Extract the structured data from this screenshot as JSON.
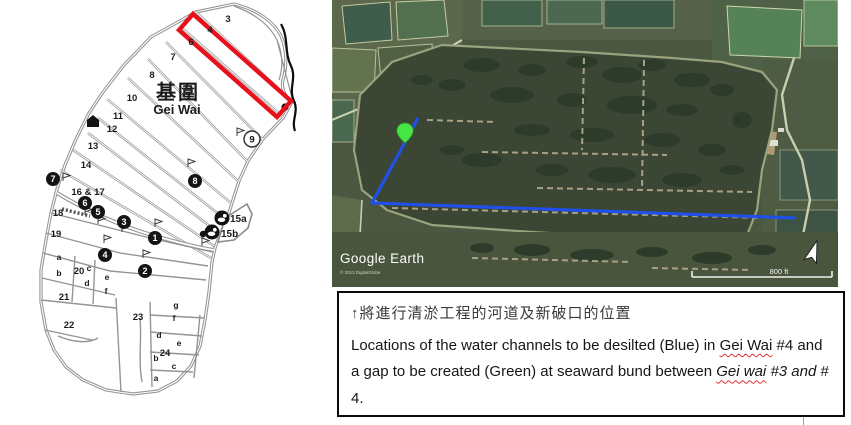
{
  "figure": {
    "map": {
      "title_zh": "基圍",
      "title_en": "Gei Wai",
      "pond_labels": [
        {
          "t": "3",
          "x": 228,
          "y": 22,
          "c": "num"
        },
        {
          "t": "4",
          "x": 210,
          "y": 33,
          "c": "num"
        },
        {
          "t": "6",
          "x": 191,
          "y": 45,
          "c": "num"
        },
        {
          "t": "7",
          "x": 173,
          "y": 60,
          "c": "num"
        },
        {
          "t": "8",
          "x": 152,
          "y": 78,
          "c": "num"
        },
        {
          "t": "10",
          "x": 132,
          "y": 101,
          "c": "num"
        },
        {
          "t": "11",
          "x": 118,
          "y": 119,
          "c": "num"
        },
        {
          "t": "12",
          "x": 112,
          "y": 132,
          "c": "num"
        },
        {
          "t": "13",
          "x": 93,
          "y": 149,
          "c": "num"
        },
        {
          "t": "14",
          "x": 86,
          "y": 168,
          "c": "num"
        },
        {
          "t": "16 & 17",
          "x": 88,
          "y": 195,
          "c": "num"
        },
        {
          "t": "18",
          "x": 58,
          "y": 216,
          "c": "num"
        },
        {
          "t": "19",
          "x": 56,
          "y": 237,
          "c": "num"
        },
        {
          "t": "20",
          "x": 79,
          "y": 274,
          "c": "num"
        },
        {
          "t": "21",
          "x": 64,
          "y": 300,
          "c": "num"
        },
        {
          "t": "22",
          "x": 69,
          "y": 328,
          "c": "num"
        },
        {
          "t": "23",
          "x": 138,
          "y": 320,
          "c": "num"
        },
        {
          "t": "24",
          "x": 165,
          "y": 356,
          "c": "num"
        },
        {
          "t": "a",
          "x": 59,
          "y": 260,
          "c": "let"
        },
        {
          "t": "b",
          "x": 59,
          "y": 276,
          "c": "let"
        },
        {
          "t": "c",
          "x": 89,
          "y": 271,
          "c": "let"
        },
        {
          "t": "d",
          "x": 87,
          "y": 286,
          "c": "let"
        },
        {
          "t": "e",
          "x": 107,
          "y": 280,
          "c": "let"
        },
        {
          "t": "f",
          "x": 106,
          "y": 294,
          "c": "let"
        },
        {
          "t": "g",
          "x": 176,
          "y": 308,
          "c": "let"
        },
        {
          "t": "f",
          "x": 174,
          "y": 321,
          "c": "let"
        },
        {
          "t": "d",
          "x": 159,
          "y": 338,
          "c": "let"
        },
        {
          "t": "e",
          "x": 179,
          "y": 346,
          "c": "let"
        },
        {
          "t": "b",
          "x": 156,
          "y": 361,
          "c": "let"
        },
        {
          "t": "c",
          "x": 174,
          "y": 369,
          "c": "let"
        },
        {
          "t": "a",
          "x": 156,
          "y": 381,
          "c": "let"
        },
        {
          "t": "15a",
          "x": 230,
          "y": 222,
          "c": "site"
        },
        {
          "t": "15b",
          "x": 221,
          "y": 237,
          "c": "site"
        }
      ],
      "badges": [
        {
          "n": "1",
          "x": 155,
          "y": 238
        },
        {
          "n": "2",
          "x": 145,
          "y": 271
        },
        {
          "n": "3",
          "x": 124,
          "y": 222
        },
        {
          "n": "4",
          "x": 105,
          "y": 255
        },
        {
          "n": "5",
          "x": 98,
          "y": 212
        },
        {
          "n": "6",
          "x": 85,
          "y": 203
        },
        {
          "n": "7",
          "x": 53,
          "y": 179
        },
        {
          "n": "8",
          "x": 195,
          "y": 181
        }
      ],
      "open_circle": {
        "n": "9",
        "x": 252,
        "y": 139
      },
      "highlight_color": "#e8111b"
    },
    "satellite": {
      "watermark": "Google Earth",
      "attribution": "© 2013 DigitalGlobe",
      "scale_label": "800 ft",
      "channel_color": "#2050e8",
      "gap_pin_color": "#46e546"
    },
    "caption": {
      "chinese": "↑將進行清淤工程的河道及新破口的位置",
      "english": {
        "p1": "Locations of the water channels to be desilted (Blue) in ",
        "gei_wai_1": "Gei Wai",
        "p2": " #4 and a gap to be created (Green) at seaward bund between ",
        "gei_wai_2": "Gei wai",
        "p3": " ",
        "italic_ref": "#3 and",
        "p4": " # 4."
      }
    }
  }
}
